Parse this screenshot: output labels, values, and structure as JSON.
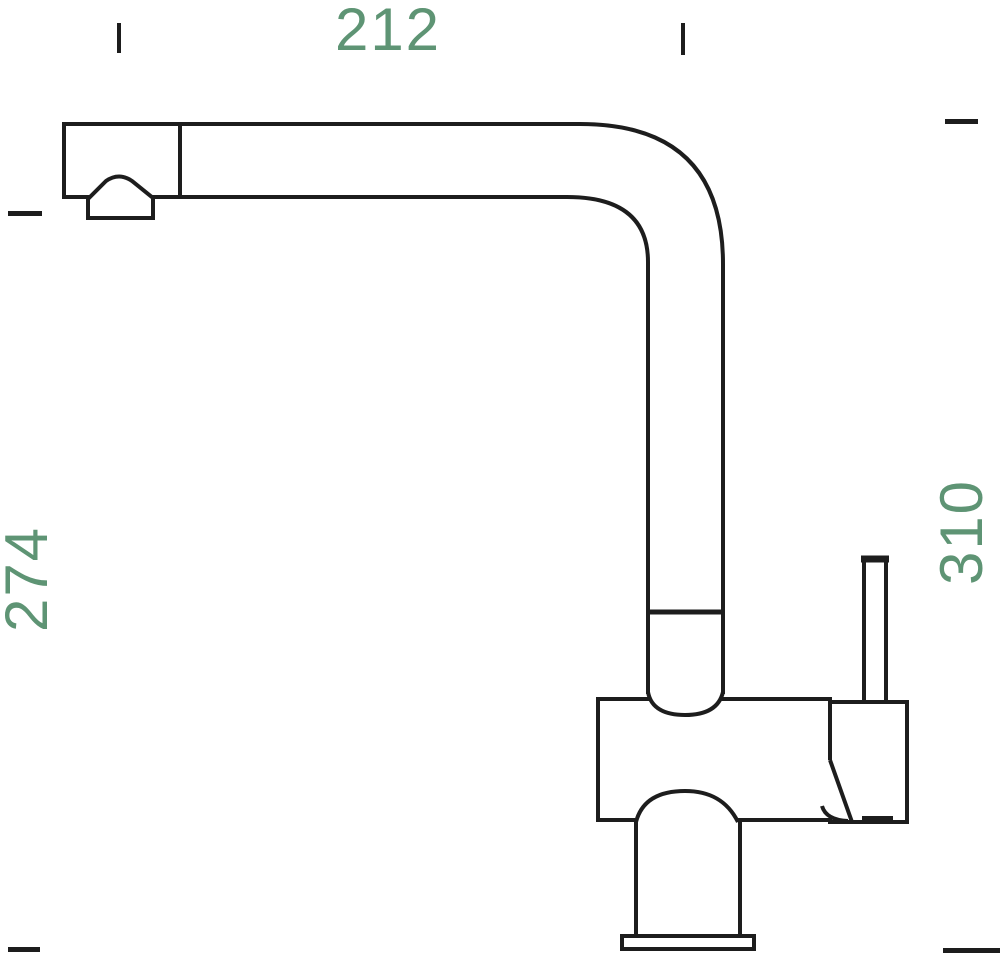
{
  "figure": {
    "subject": "kitchen-faucet-side-view-technical-drawing"
  },
  "dimensions": {
    "top": {
      "value": "212"
    },
    "left": {
      "value": "274"
    },
    "right": {
      "value": "310"
    }
  },
  "colors": {
    "dimension_text": "#5e9474",
    "line": "#1d1d1d",
    "background": "#ffffff"
  }
}
